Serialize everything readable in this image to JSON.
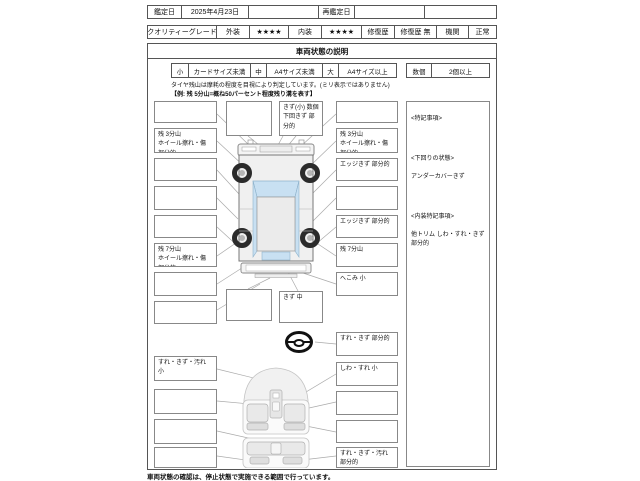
{
  "header": {
    "appraisal_date_label": "鑑定日",
    "appraisal_date": "2025年4月23日",
    "blank1": "",
    "re_appraisal_date_label": "再鑑定日",
    "blank2": "",
    "blank3": "",
    "grade_label": "クオリティーグレード",
    "exterior_label": "外装",
    "exterior_stars": "★★★★",
    "interior_label": "内装",
    "interior_stars": "★★★★",
    "repair_label": "修復歴",
    "repair_value": "修復歴 無",
    "engine_label": "機関",
    "engine_value": "正常"
  },
  "title": "車両状態の説明",
  "size_legend": {
    "small_label": "小",
    "small_desc": "カードサイズ未満",
    "medium_label": "中",
    "medium_desc": "A4サイズ未満",
    "large_label": "大",
    "large_desc": "A4サイズ以上",
    "count_label": "数個",
    "count_desc": "2個以上"
  },
  "tire_note": {
    "line1": "タイヤ残山は摩耗の程度を目視により判定しています。(ミリ表示ではありません)",
    "line2": "【例: 残 5分山=概ね50パーセント程度残り溝を表す】"
  },
  "exterior_boxes": {
    "left": [
      "",
      "残 3分山\nホイール擦れ・傷 部分的",
      "",
      "",
      "",
      "残 7分山\nホイール擦れ・傷 部分的",
      "",
      ""
    ],
    "top_center_a": "",
    "top_center_b": "きず(小) 数個\n下回きず 部分的",
    "bottom_center_a": "",
    "bottom_center_b": "きず 中",
    "right": [
      "",
      "残 3分山\nホイール擦れ・傷 部分的",
      "エッジきず 部分的",
      "",
      "エッジきず 部分的",
      "残 7分山",
      "へこみ 小"
    ]
  },
  "remarks_panel": {
    "title": "<特記事項>",
    "underbody_title": "<下回りの状態>",
    "underbody_value": "アンダーカバーきず",
    "interior_title": "<内装特記事項>",
    "interior_value": "他トリム しわ・すれ・きず 部分的"
  },
  "interior_boxes": {
    "left": [
      "すれ・きず・汚れ 小",
      "",
      "",
      ""
    ],
    "right": [
      "すれ・きず 部分的",
      "しわ・すれ 小",
      "",
      "",
      "すれ・きず・汚れ 部分的"
    ]
  },
  "footer_note": "車両状態の確認は、停止状態で実施できる範囲で行っています。",
  "colors": {
    "glass_blue": "#c8e0f2",
    "body_gray": "#f0f0f0",
    "line_gray": "#aaaaaa"
  }
}
